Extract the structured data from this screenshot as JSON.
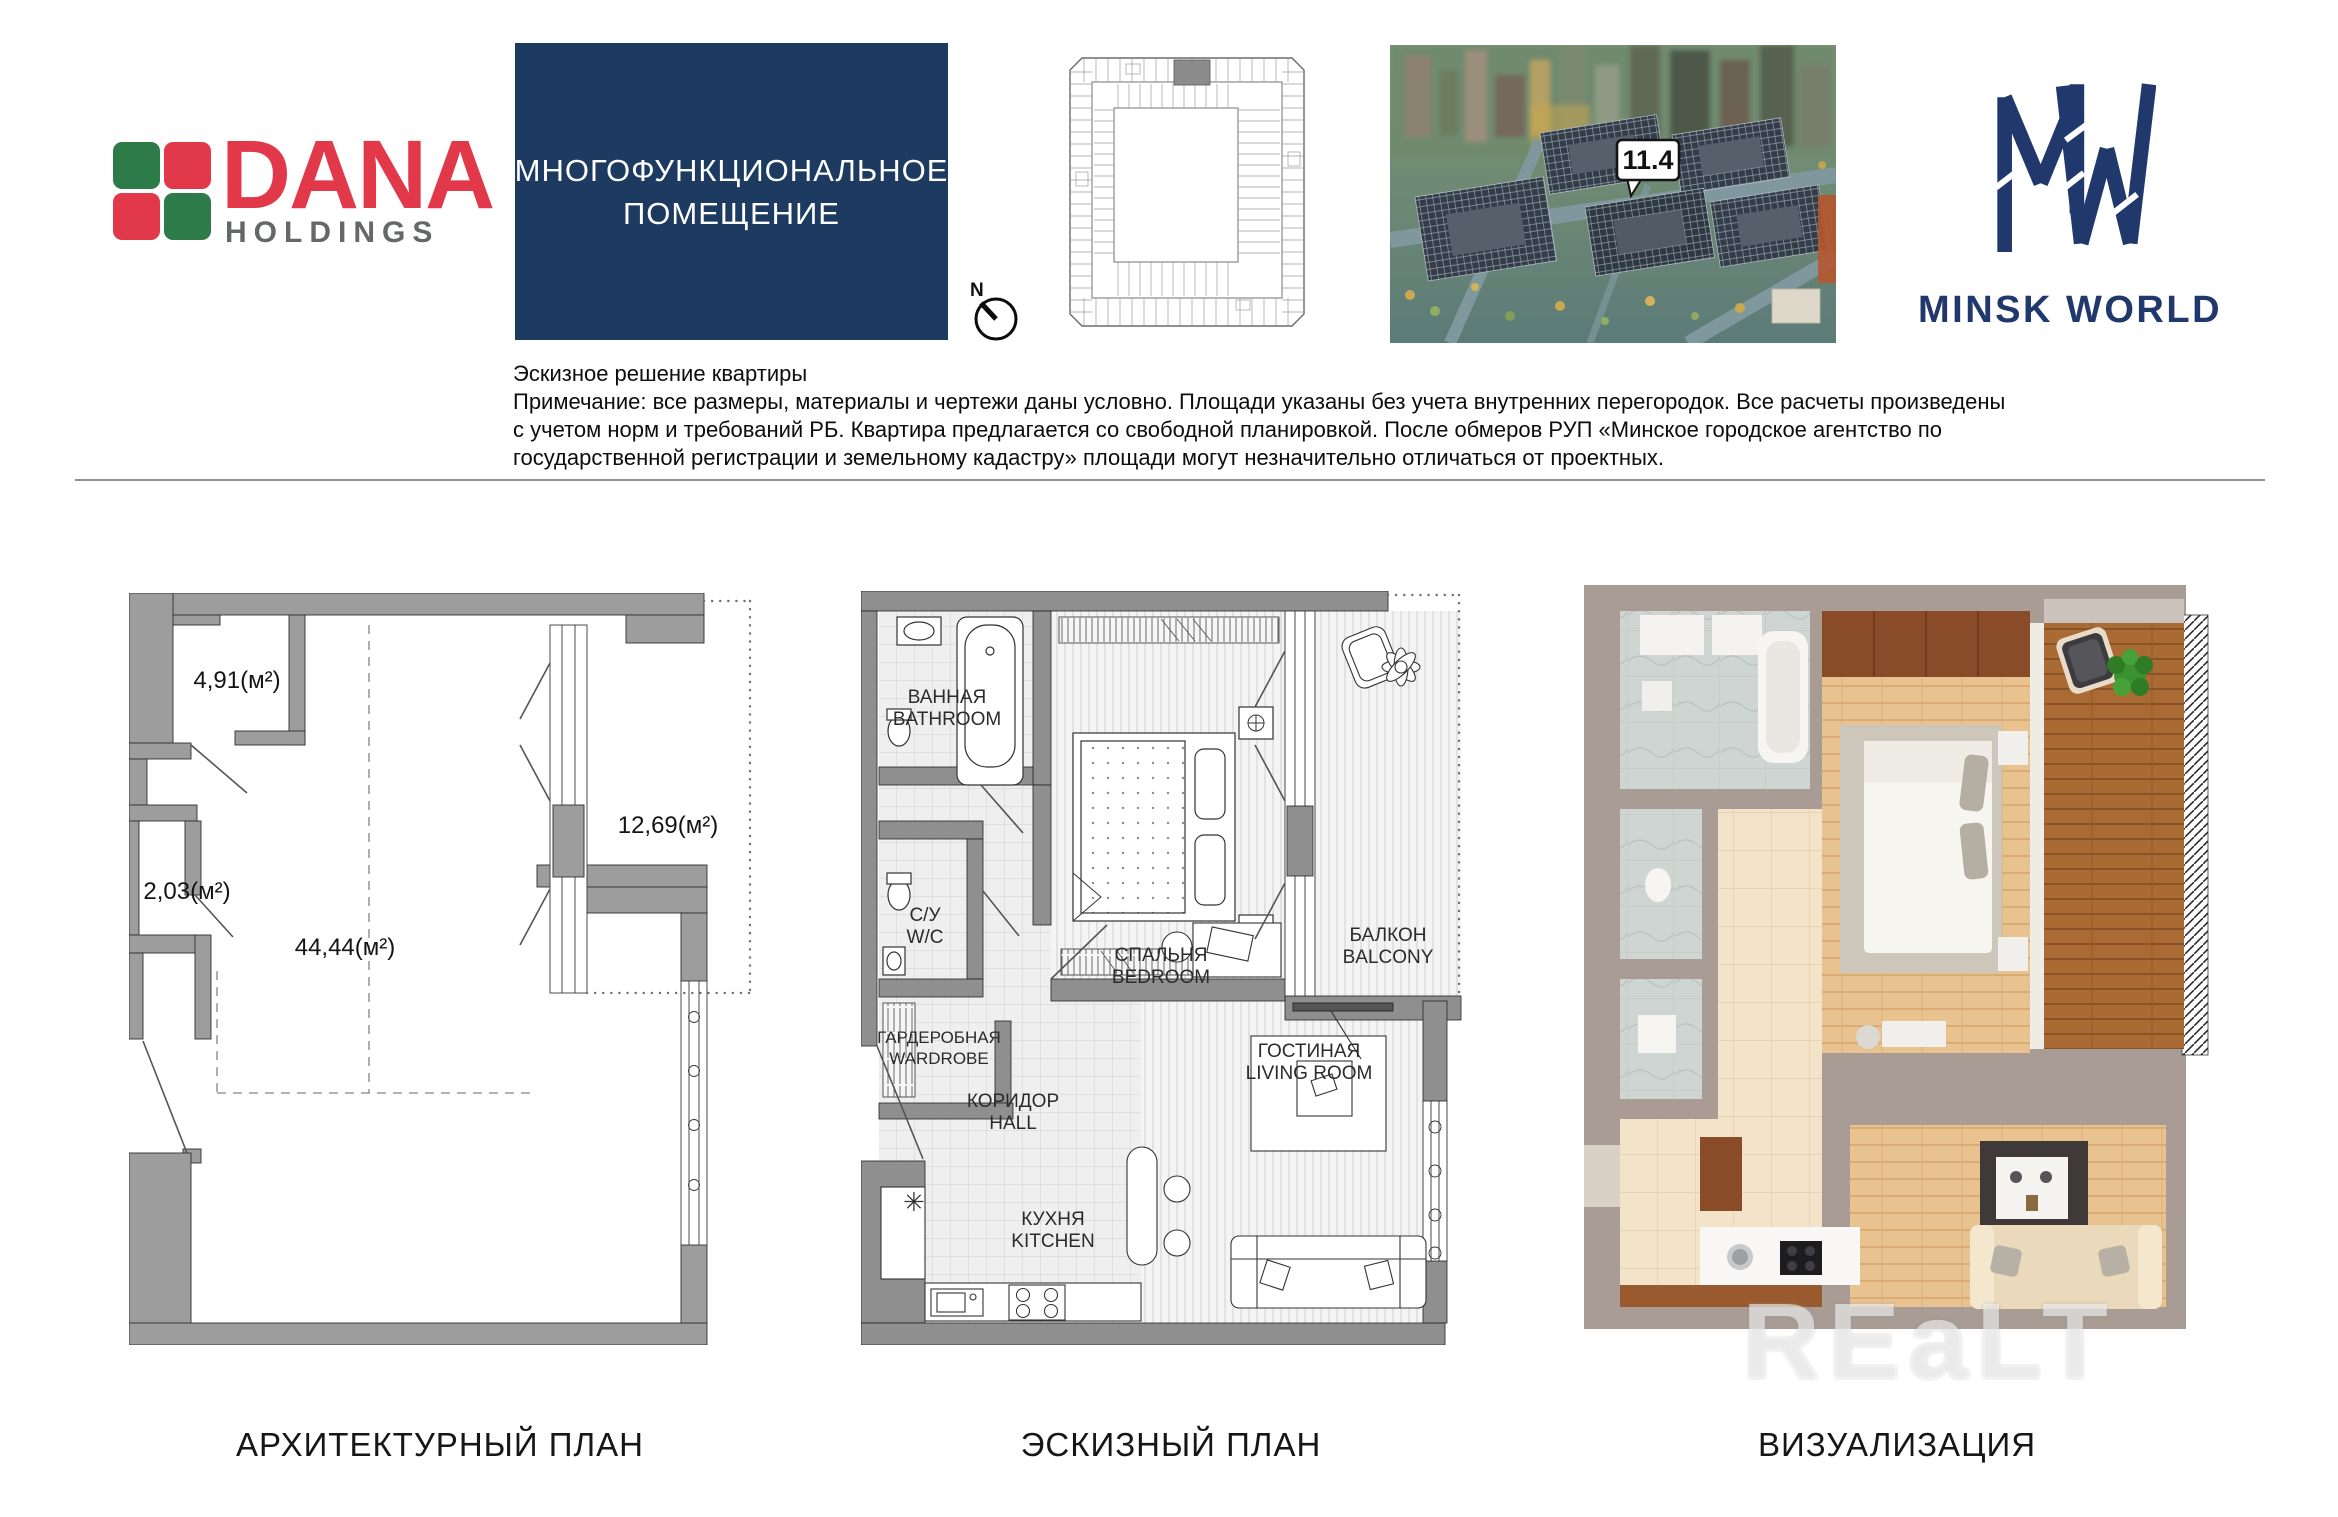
{
  "header": {
    "dana": {
      "word": "DANA",
      "sub": "HOLDINGS"
    },
    "title_box": {
      "line1": "МНОГОФУНКЦИОНАЛЬНОЕ",
      "line2": "ПОМЕЩЕНИЕ"
    },
    "compass": {
      "north": "N"
    },
    "aerial": {
      "unit_label": "11.4"
    },
    "minsk": {
      "name": "MINSK WORLD"
    }
  },
  "notes": {
    "title": "Эскизное решение квартиры",
    "line1": "Примечание: все размеры, материалы и чертежи даны условно. Площади указаны без учета внутренних перегородок. Все расчеты произведены",
    "line2": "с учетом норм и требований РБ. Квартира предлагается со свободной планировкой. После обмеров РУП «Минское городское агентство по",
    "line3": "государственной регистрации и земельному кадастру» площади могут незначительно отличаться от проектных."
  },
  "architectural": {
    "caption": "АРХИТЕКТУРНЫЙ ПЛАН",
    "area_room1": "4,91(м²)",
    "area_room2": "2,03(м²)",
    "area_main": "44,44(м²)",
    "area_balcony": "12,69(м²)"
  },
  "sketch": {
    "caption": "ЭСКИЗНЫЙ ПЛАН",
    "bathroom_ru": "ВАННАЯ",
    "bathroom_en": "BATHROOM",
    "wc_ru": "С/У",
    "wc_en": "W/C",
    "wardrobe_ru": "ГАРДЕРОБНАЯ",
    "wardrobe_en": "WARDROBE",
    "hall_ru": "КОРИДОР",
    "hall_en": "HALL",
    "kitchen_ru": "КУХНЯ",
    "kitchen_en": "KITCHEN",
    "bedroom_ru": "СПАЛЬНЯ",
    "bedroom_en": "BEDROOM",
    "balcony_ru": "БАЛКОН",
    "balcony_en": "BALCONY",
    "living_ru": "ГОСТИНАЯ",
    "living_en": "LIVING ROOM"
  },
  "visualization": {
    "caption": "ВИЗУАЛИЗАЦИЯ"
  },
  "watermark": "REaLT",
  "colors": {
    "accent_navy": "#1d3a60",
    "logo_navy": "#20386b",
    "dana_red": "#e2394a",
    "dana_green": "#2c7b49"
  }
}
